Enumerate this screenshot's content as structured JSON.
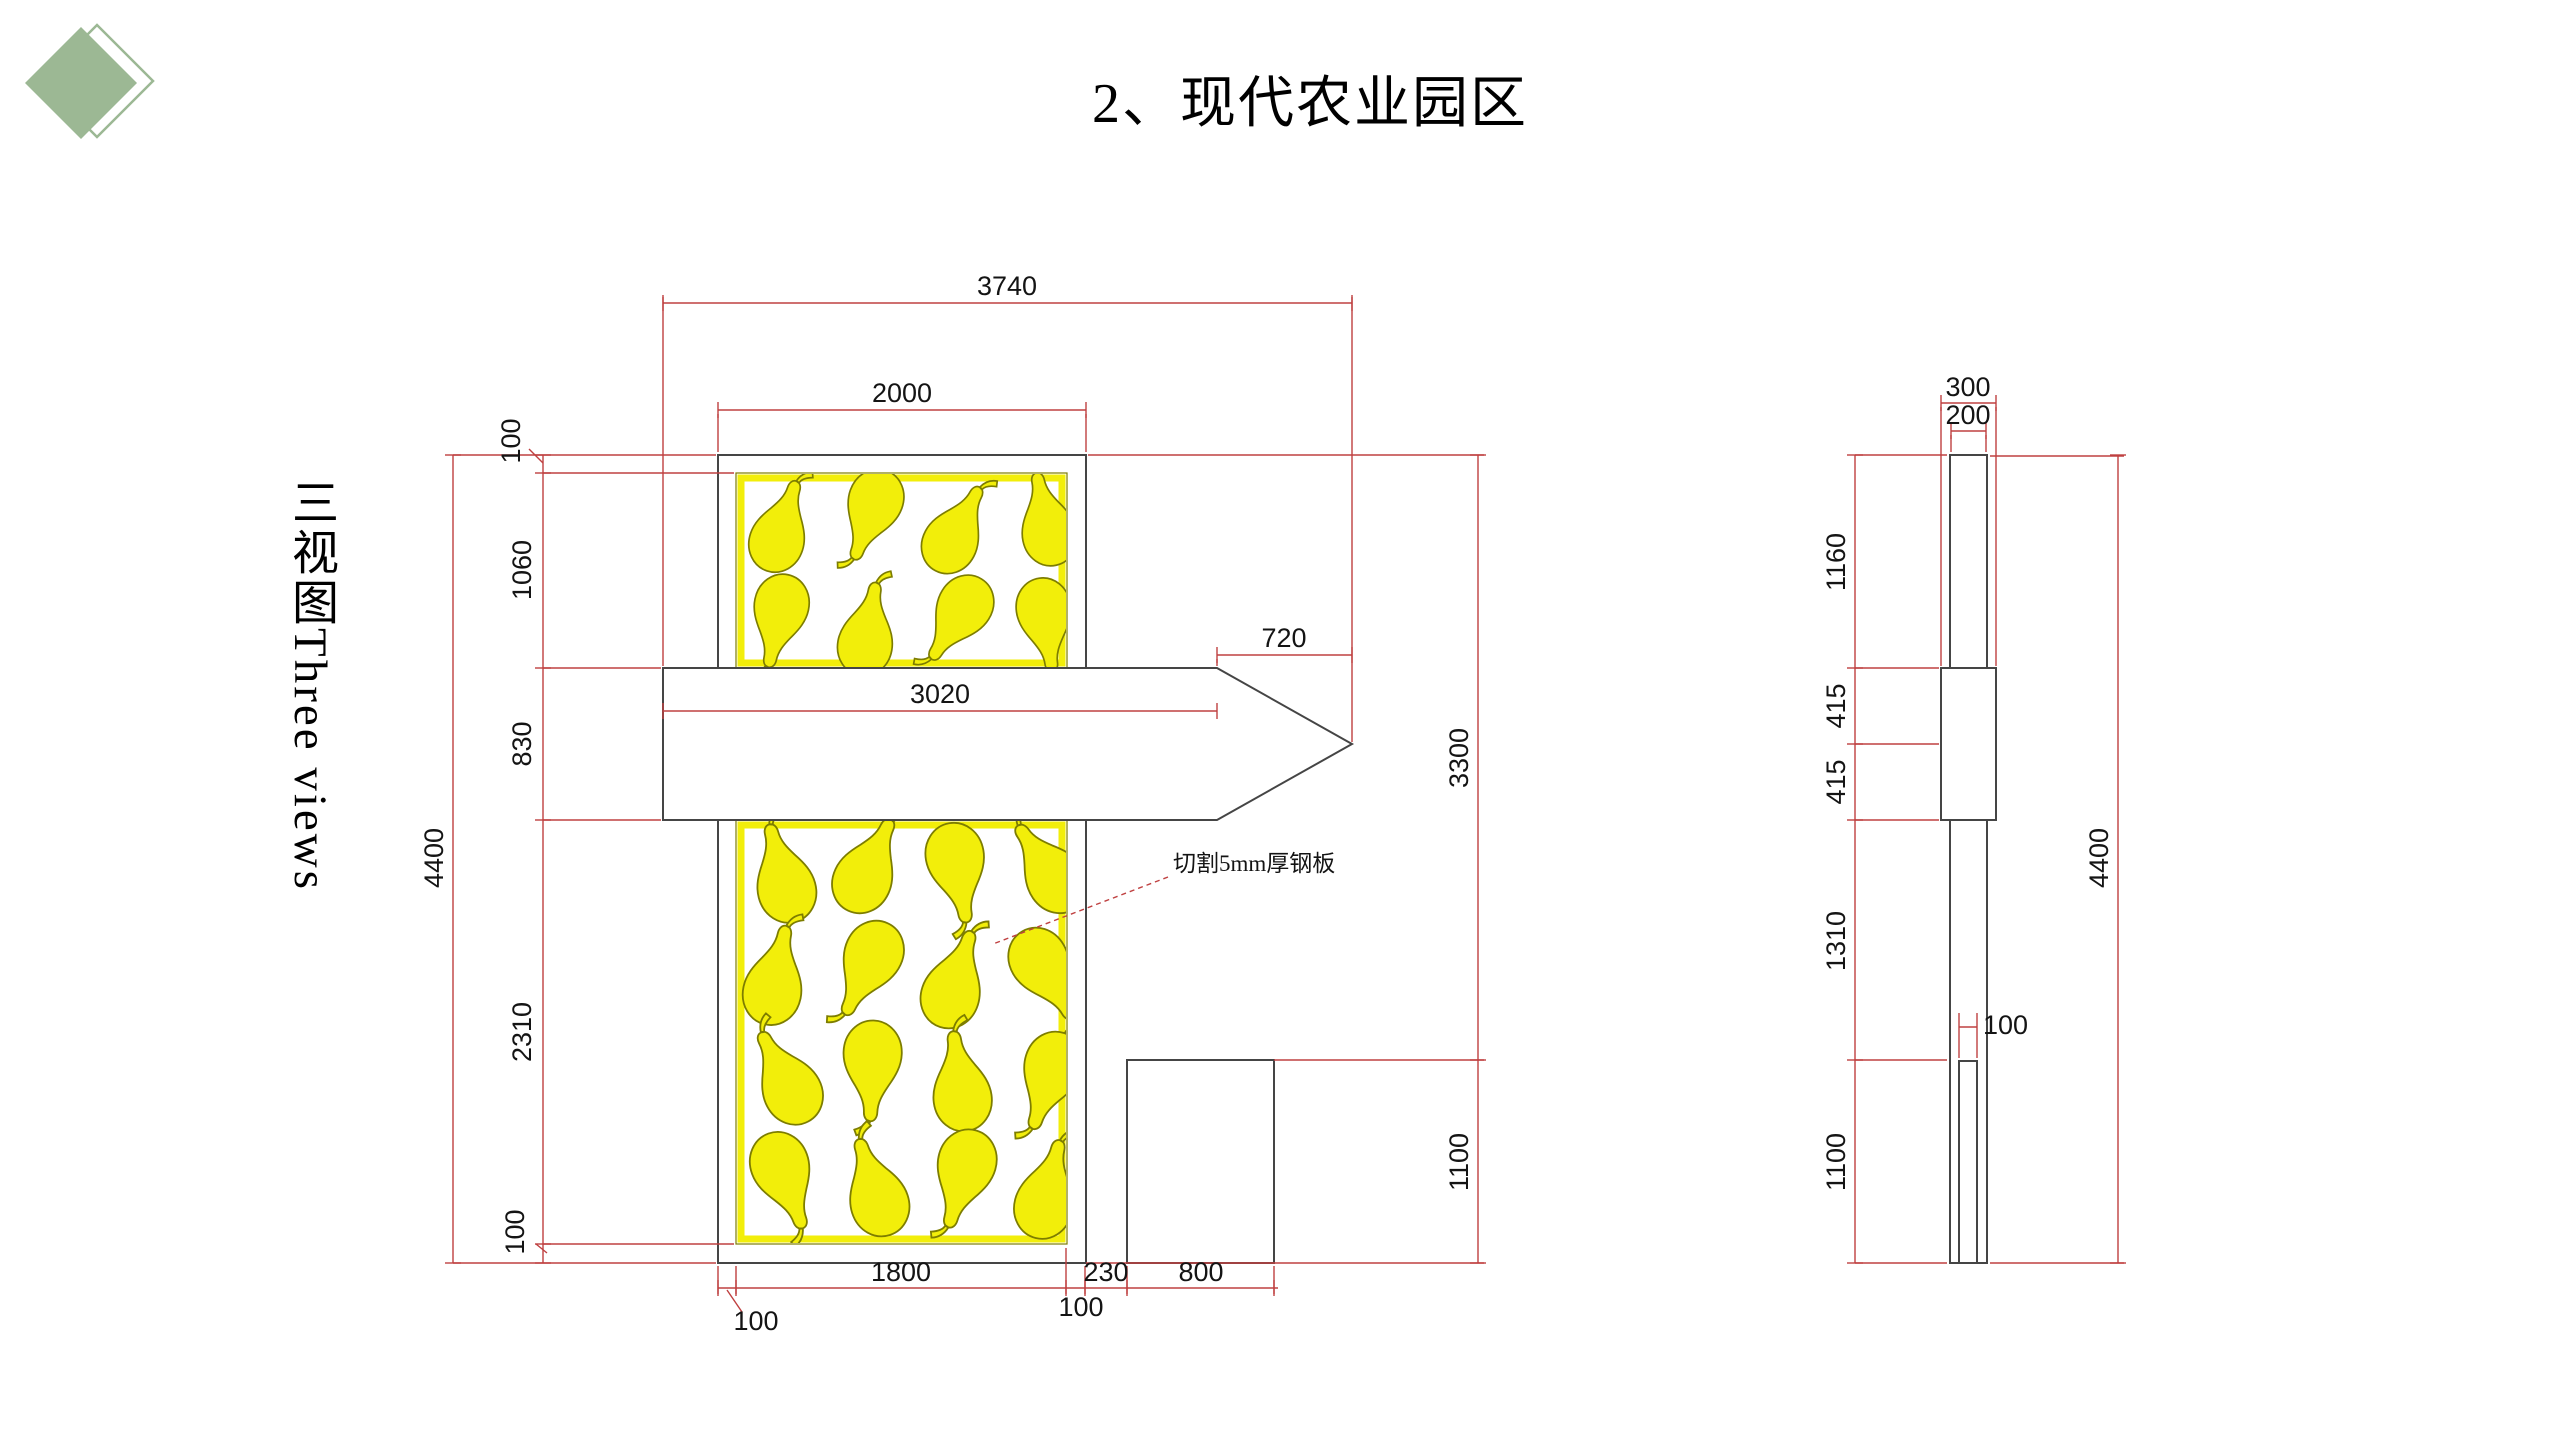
{
  "page": {
    "title": "2、现代农业园区",
    "vertical_label": "三视图Three views"
  },
  "colors": {
    "dimension_red": "#bf4040",
    "drawing_line": "#454545",
    "pear_yellow": "#f2ee0a",
    "pear_outline": "#7d7d00",
    "logo_green": "#9cb894",
    "background": "#ffffff"
  },
  "annotation": {
    "steel_plate_note": "切割5mm厚钢板"
  },
  "front_view": {
    "dims": {
      "overall_width": "3740",
      "panel_width": "2000",
      "top_border": "100",
      "upper_yellow_height": "1060",
      "band_height": "830",
      "lower_yellow_height": "2310",
      "bottom_border": "100",
      "overall_height": "4400",
      "arrow_head_length": "720",
      "arrow_shaft_length": "3020",
      "panel_top_to_pedestal": "3300",
      "pedestal_height": "1100",
      "yellow_width": "1800",
      "left_border": "100",
      "right_border": "100",
      "panel_to_pedestal_gap": "230",
      "pedestal_width": "800"
    }
  },
  "side_view": {
    "dims": {
      "cap_width": "300",
      "column_width": "200",
      "upper_section": "1160",
      "band_upper_half": "415",
      "band_lower_half": "415",
      "lower_section": "1310",
      "base_section": "1100",
      "overall_height": "4400",
      "plate_width": "100"
    }
  }
}
